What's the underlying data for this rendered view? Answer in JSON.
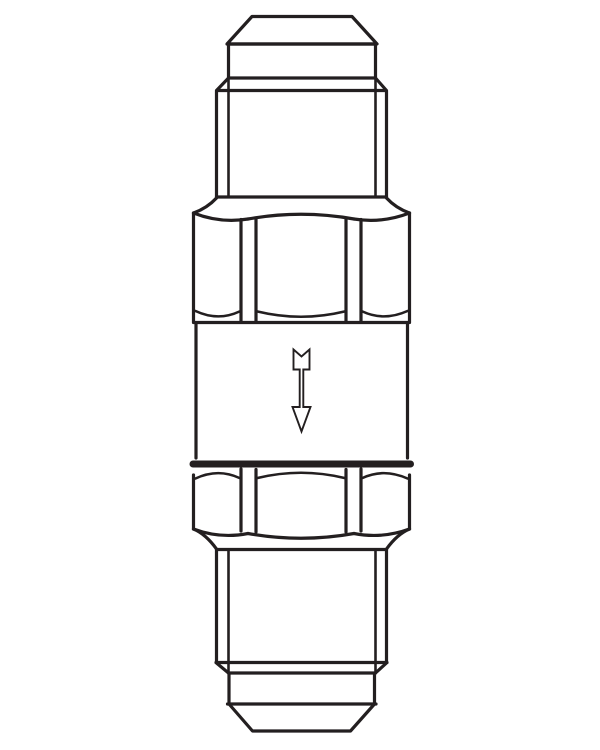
{
  "figure": {
    "type": "technical-line-drawing",
    "subject": "in-line check valve fitting, front elevation",
    "aria_label": "Black-and-white line drawing of an in-line check valve: chamfered top cap, threaded male connector, hex nut, cylindrical valve body marked with a downward flow-direction arrow, a second hex nut and a threaded male connector with chamfered cap at the bottom",
    "flow_direction": "down"
  },
  "icons": {
    "flow_arrow": "flow-direction-down-arrow-icon"
  },
  "colors": {
    "line": "#231f20",
    "background": "#ffffff"
  }
}
